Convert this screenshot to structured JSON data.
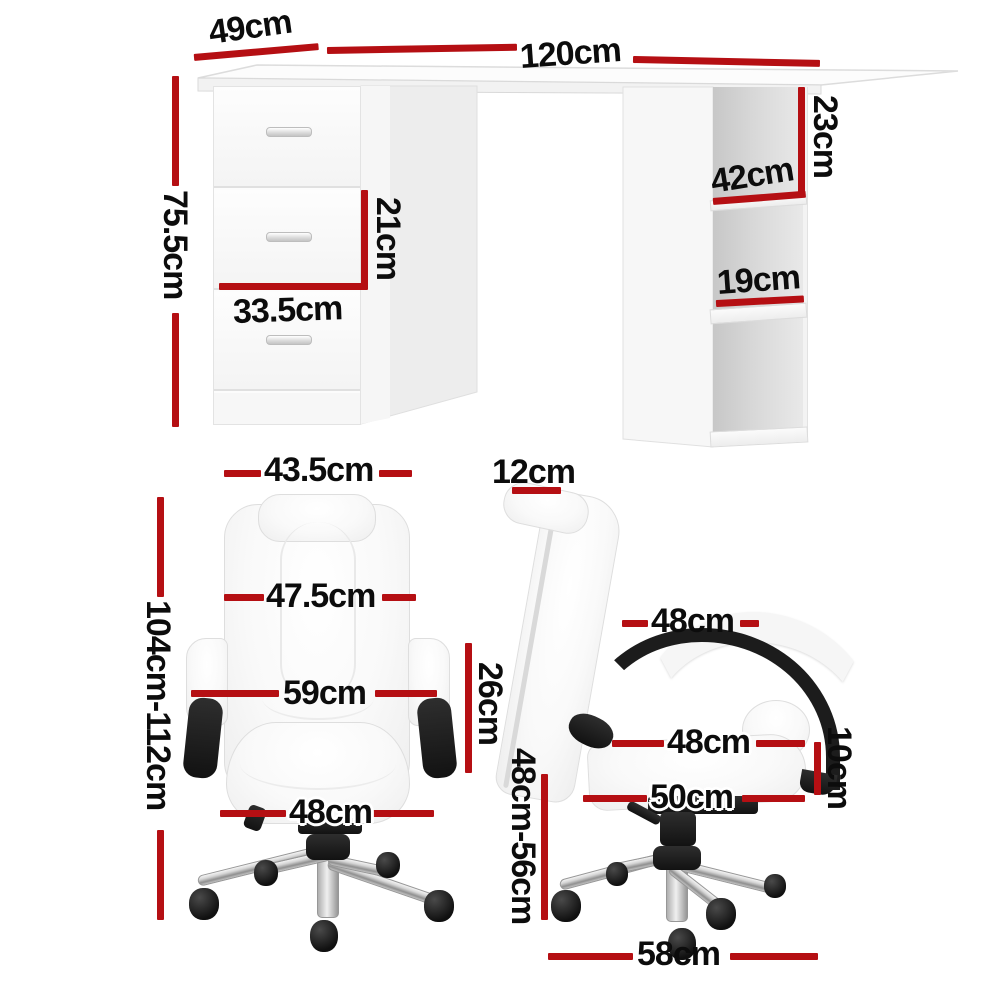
{
  "colors": {
    "dimension_line": "#b50f13",
    "label_text": "#0c0c0c",
    "furniture_white": "#fbfbfb",
    "furniture_black": "#1b1b1b",
    "chrome": "#c9c9c9"
  },
  "desk": {
    "depth": "49cm",
    "width": "120cm",
    "height": "75.5cm",
    "shelf_top_height": "23cm",
    "shelf_depth": "42cm",
    "shelf_middle_height": "19cm",
    "drawer_height": "21cm",
    "drawer_width": "33.5cm"
  },
  "chair_front": {
    "headrest_width": "43.5cm",
    "backrest_width": "47.5cm",
    "width_with_armrests": "59cm",
    "armrest_height": "26cm",
    "seat_width": "48cm",
    "overall_height": "104cm-112cm"
  },
  "chair_side": {
    "headrest_thickness": "12cm",
    "backrest_width": "48cm",
    "seat_depth": "48cm",
    "seat_thickness": "10cm",
    "seat_length": "50cm",
    "seat_height_range": "48cm-56cm",
    "base_diameter": "58cm"
  }
}
